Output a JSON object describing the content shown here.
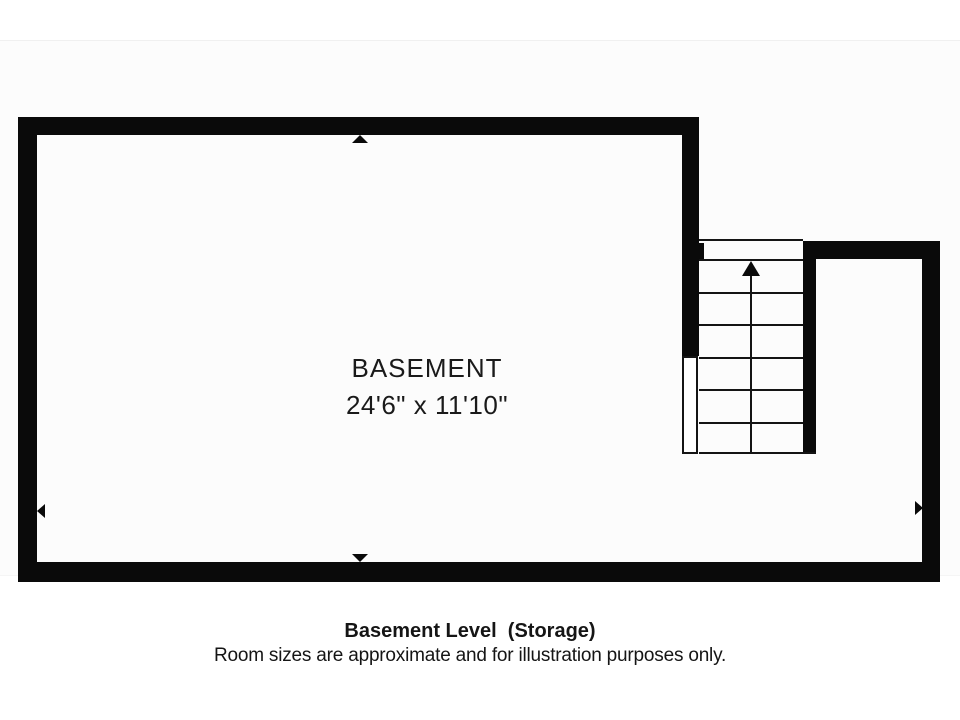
{
  "plan": {
    "room": {
      "name": "BASEMENT",
      "size": "24'6\" x 11'10\""
    },
    "stairs": {
      "tread_count": 6,
      "direction": "up",
      "icon": "stairs-up-arrow-icon"
    },
    "wall_markers": [
      {
        "side": "top",
        "icon": "triangle-up-icon"
      },
      {
        "side": "bottom",
        "icon": "triangle-down-icon"
      },
      {
        "side": "left",
        "icon": "triangle-left-icon"
      },
      {
        "side": "right",
        "icon": "triangle-right-icon"
      }
    ]
  },
  "caption": {
    "title": "Basement Level  (Storage)",
    "disclaimer": "Room sizes are approximate and for illustration purposes only."
  },
  "colors": {
    "wall": "#0a0a0a",
    "text": "#1a1a1a",
    "plan_background": "#fcfcfc",
    "page_background": "#ffffff"
  }
}
